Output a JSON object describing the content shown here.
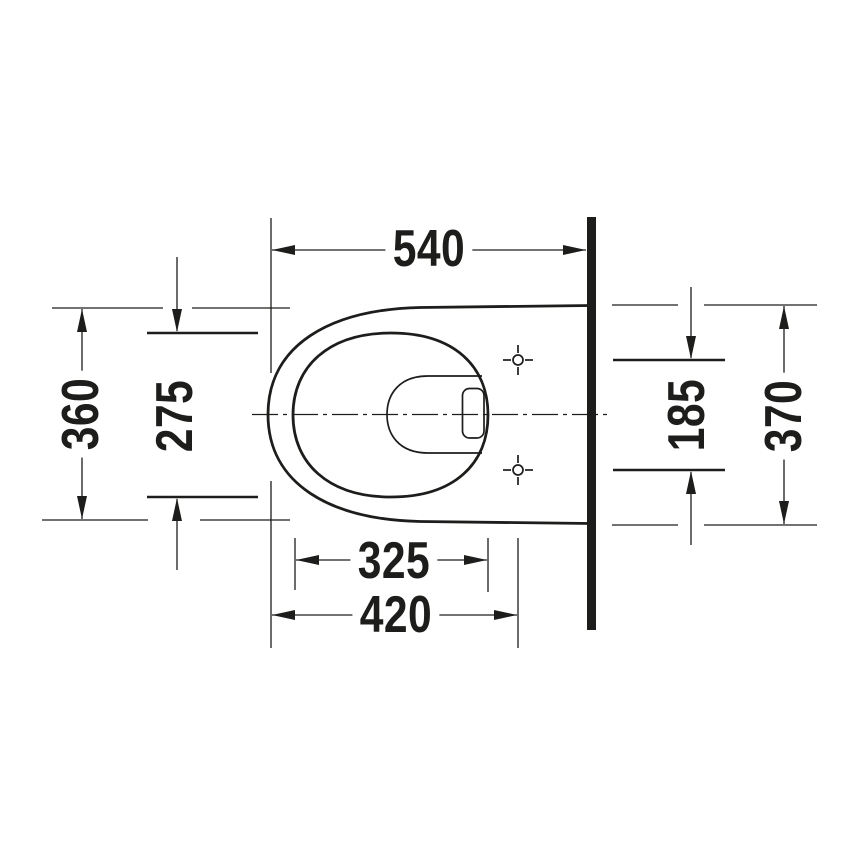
{
  "drawing": {
    "view": "plan",
    "background": "#ffffff",
    "line_color": "#1d1d1b",
    "dimensions": {
      "overall_depth": {
        "value": "540",
        "orientation": "horizontal"
      },
      "front_width": {
        "value": "360",
        "orientation": "vertical"
      },
      "seat_opening_width": {
        "value": "275",
        "orientation": "vertical"
      },
      "fixing_hole_spacing": {
        "value": "185",
        "orientation": "vertical"
      },
      "overall_width": {
        "value": "370",
        "orientation": "vertical"
      },
      "seat_opening_length": {
        "value": "325",
        "orientation": "horizontal"
      },
      "fixing_hole_distance": {
        "value": "420",
        "orientation": "horizontal"
      }
    }
  }
}
